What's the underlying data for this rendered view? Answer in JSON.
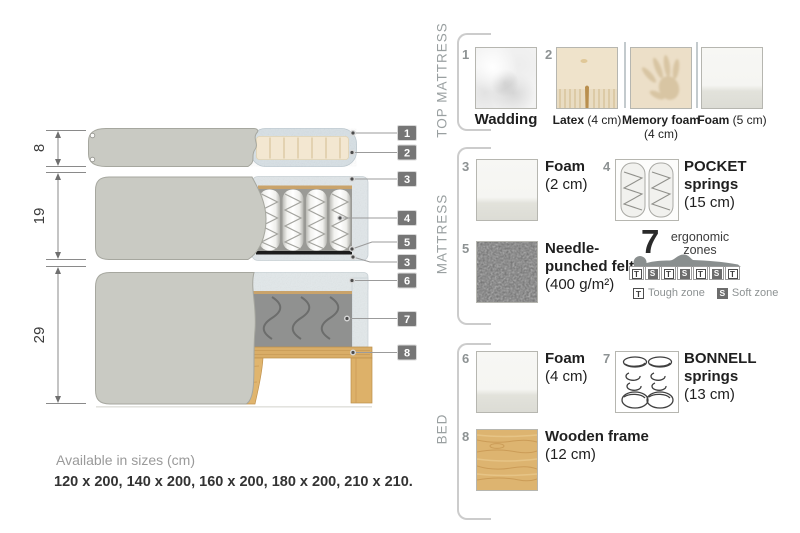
{
  "colors": {
    "fabric_gray": "#c9cac3",
    "foam_speckle": "#e0e6e9",
    "latex_beige": "#f3e7d1",
    "wood": "#ddb470",
    "felt_dark": "#1c1c1c",
    "callout_chip": "#767676",
    "text_muted": "#8d9293",
    "text_dark": "#1f1f1f"
  },
  "diagram": {
    "dims": [
      "8",
      "19",
      "29"
    ],
    "callouts": [
      "1",
      "2",
      "3",
      "4",
      "5",
      "3",
      "6",
      "7",
      "8"
    ]
  },
  "sizes": {
    "title": "Available in sizes (cm)",
    "values": "120 x 200, 140 x 200, 160 x 200, 180 x 200, 210 x 210."
  },
  "legend": {
    "top_mattress": {
      "title": "TOP MATTRESS",
      "items": [
        {
          "num": "1",
          "name": "Wadding",
          "detail": ""
        },
        {
          "num": "2",
          "name": "Latex",
          "detail": "(4 cm)"
        },
        {
          "num": "",
          "name": "Memory foam",
          "detail": "(4 cm)"
        },
        {
          "num": "",
          "name": "Foam",
          "detail": "(5 cm)"
        }
      ]
    },
    "mattress": {
      "title": "MATTRESS",
      "items": [
        {
          "num": "3",
          "name": "Foam",
          "detail": "(2 cm)"
        },
        {
          "num": "4",
          "name": "POCKET springs",
          "detail": "(15 cm)"
        },
        {
          "num": "5",
          "name": "Needle-punched felt",
          "detail": "(400 g/m²)"
        }
      ],
      "zones": {
        "count": "7",
        "label": "ergonomic zones",
        "pattern": [
          "T",
          "S",
          "T",
          "S",
          "T",
          "S",
          "T"
        ],
        "tough_key": "T",
        "tough_label": "Tough zone",
        "soft_key": "S",
        "soft_label": "Soft zone"
      }
    },
    "bed": {
      "title": "BED",
      "items": [
        {
          "num": "6",
          "name": "Foam",
          "detail": "(4 cm)"
        },
        {
          "num": "7",
          "name": "BONNELL springs",
          "detail": "(13 cm)"
        },
        {
          "num": "8",
          "name": "Wooden frame",
          "detail": "(12 cm)"
        }
      ]
    }
  }
}
